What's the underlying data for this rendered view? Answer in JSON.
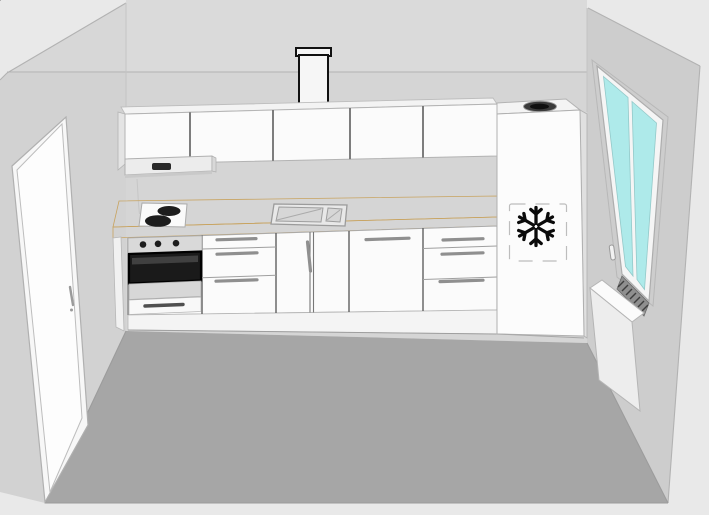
{
  "colors": {
    "background": "#e9e9e9",
    "back_wall": "#d5d5d5",
    "back_wall_upper": "#dadada",
    "left_wall": "#d2d2d2",
    "left_wall_upper": "#d7d7d7",
    "right_wall": "#cdcdcd",
    "floor": "#a6a6a6",
    "cabinet_white": "#fbfbfb",
    "cabinet_top_face": "#f3f3f3",
    "countertop_top": "#f2cf92",
    "countertop_front": "#e9bf7d",
    "window_glass": "#aeeaea",
    "door_panel": "#fdfdfd",
    "oven_glass": "#1a1a1a",
    "appliance_dark": "#1d1d1d",
    "snowflake": "#0a0a0a",
    "handle_gray": "#8f8f8f",
    "hood_body": "#ececec",
    "hood_panel": "#2a2a2a",
    "radiator_front": "#ededed",
    "radiator_top": "#fbfbfb",
    "freezer_front": "#fcfcfc",
    "freezer_side": "#e0e0e0",
    "vent_dark": "#3a3a3a",
    "duct_outline": "#111111",
    "duct_fill": "#f6f6f6"
  },
  "icons": {
    "freezer_symbol": "snowflake-icon",
    "fridge_top": "round-vent-icon"
  },
  "kitchen": {
    "wall_cabinet_doors": 5,
    "base_units": 6,
    "oven_knobs": 3,
    "cooktop_burners": 2,
    "sink_basins": 2,
    "window_panes": 2
  }
}
